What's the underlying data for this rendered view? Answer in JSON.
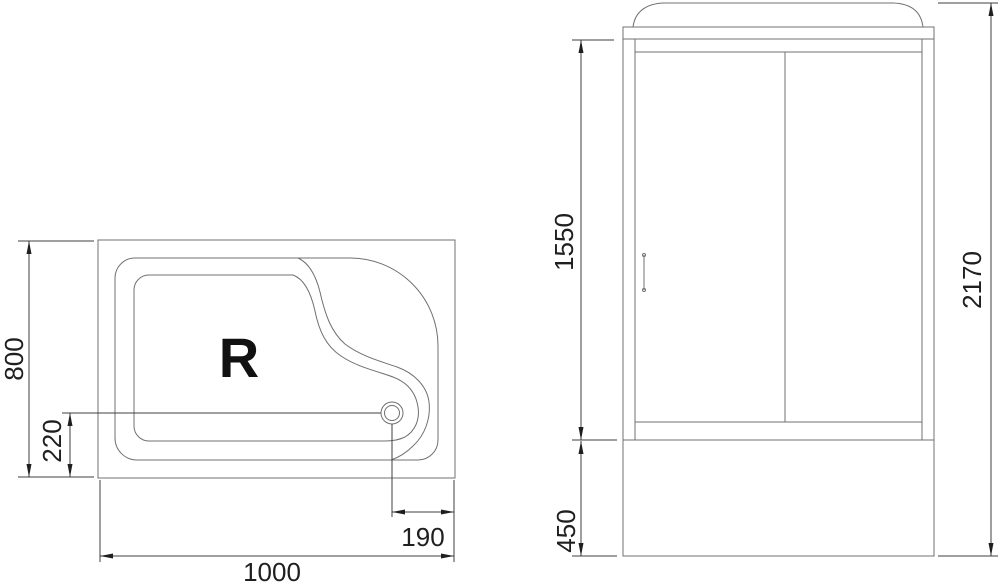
{
  "colors": {
    "line": "#707070",
    "dim": "#3f3f3f",
    "arrow": "#1f1f1f",
    "background": "#ffffff"
  },
  "top_view": {
    "tray_label": "R",
    "dim_width": "1000",
    "dim_depth": "800",
    "dim_drain_from_bottom": "220",
    "dim_drain_from_right": "190"
  },
  "front_view": {
    "dim_door_height": "1550",
    "dim_total_height": "2170",
    "dim_base_height": "450"
  }
}
